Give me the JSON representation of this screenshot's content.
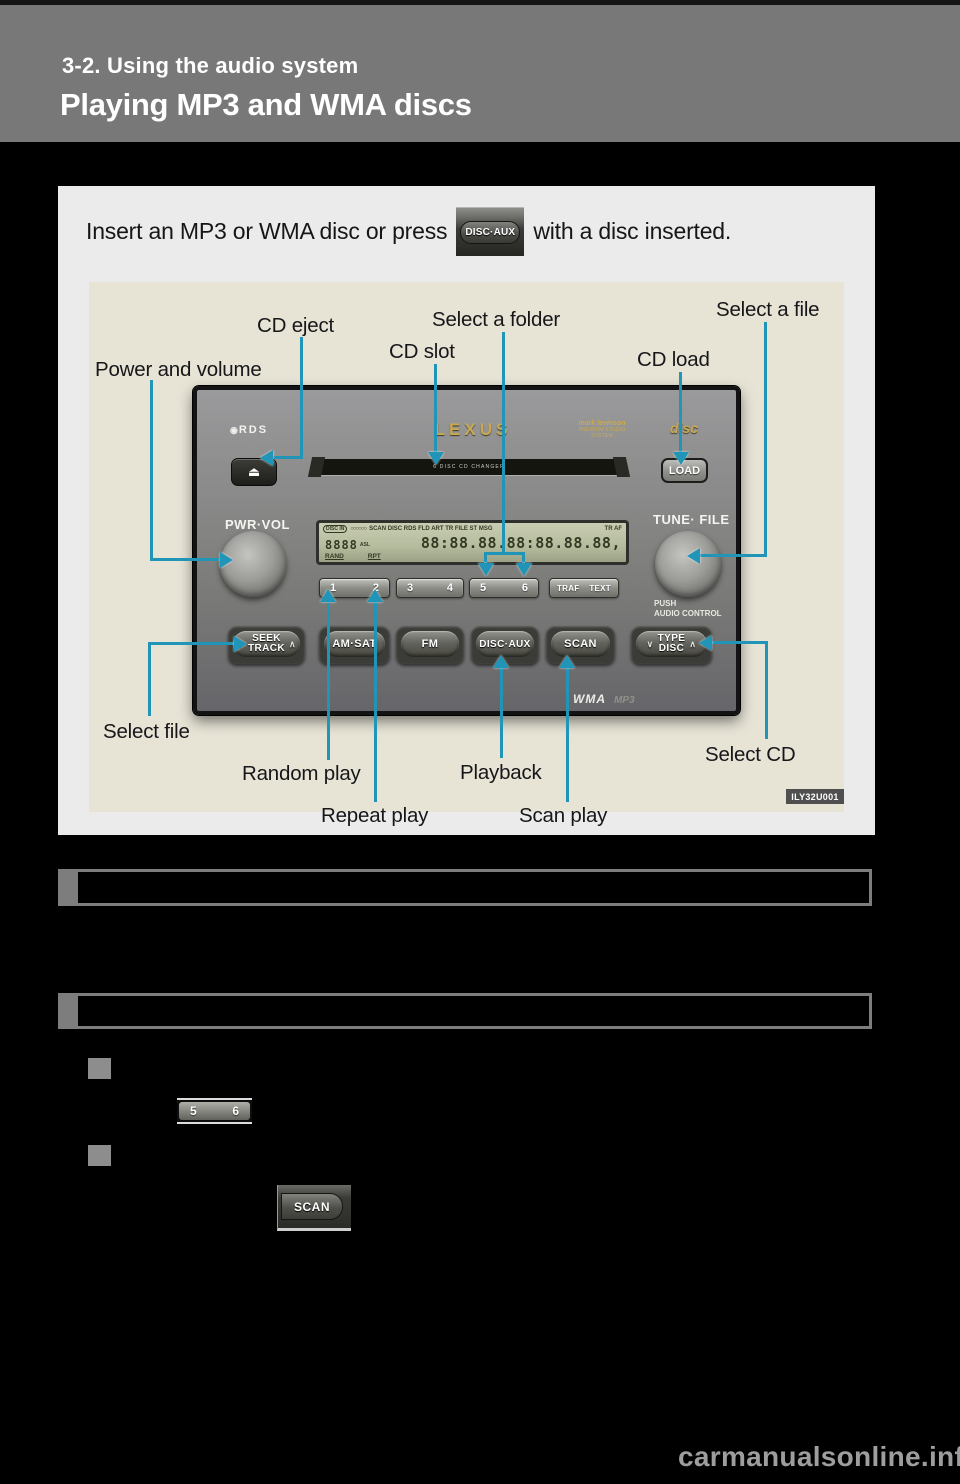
{
  "colors": {
    "page_bg": "#000000",
    "header_bg": "#787878",
    "content_box_bg": "#ebebeb",
    "figure_panel_bg": "#e7e4d6",
    "callout_line": "#2095b8",
    "lcd_bg": "#b9bfa4",
    "gold_logo": "#c8a952"
  },
  "header": {
    "section": "3-2. Using the audio system",
    "title": "Playing MP3 and WMA discs"
  },
  "instruction": {
    "text_before": "Insert an MP3 or WMA disc or press",
    "button_label": "DISC·AUX",
    "text_after": "with a disc inserted."
  },
  "figure": {
    "image_code": "ILY32U001",
    "callouts": {
      "power_volume": "Power and volume",
      "cd_eject": "CD eject",
      "cd_slot": "CD slot",
      "select_folder": "Select a folder",
      "cd_load": "CD load",
      "select_file_top": "Select a file",
      "select_file_bottom": "Select file",
      "random_play": "Random play",
      "repeat_play": "Repeat play",
      "playback": "Playback",
      "scan_play": "Scan play",
      "select_cd": "Select CD"
    },
    "radio": {
      "rds_icon": "◉",
      "rds_logo": "RDS",
      "eject_glyph": "⏏",
      "cd_slot_text": "6 DISC CD CHANGER",
      "brand": "LEXUS",
      "premium_line1": "mark levinson",
      "premium_line2": "PREMIUM STUDIO SYSTEM",
      "disc_logo": "disc",
      "load_button": "LOAD",
      "pwr_vol": "PWR·VOL",
      "tune_file": "TUNE· FILE",
      "lcd": {
        "disc_in": "DISC IN",
        "disc_indicators": "○○○○○○",
        "status_row": "SCAN DISC RDS FLD ART TR FILE ST MSG",
        "status_right": "TR AF",
        "digits_small": "8888",
        "asl": "ASL",
        "digits_main": "88:88.88.88:88.88.88,",
        "rand": "RAND",
        "rpt": "RPT"
      },
      "presets": [
        "1",
        "2",
        "3",
        "4",
        "5",
        "6"
      ],
      "traf": "TRAF",
      "text_btn": "TEXT",
      "chevron_down": "∨",
      "chevron_up": "∧",
      "seek_line1": "SEEK",
      "seek_line2": "TRACK",
      "am_sat": "AM·SAT",
      "fm": "FM",
      "disc_aux": "DISC·AUX",
      "scan": "SCAN",
      "type_line1": "TYPE",
      "type_line2": "DISC",
      "push_line1": "PUSH",
      "push_line2": "AUDIO CONTROL",
      "wma": "WMA",
      "mp3": "MP3"
    }
  },
  "body_images": {
    "preset_5": "5",
    "preset_6": "6",
    "scan_button": "SCAN"
  },
  "watermark": "carmanualsonline.info"
}
